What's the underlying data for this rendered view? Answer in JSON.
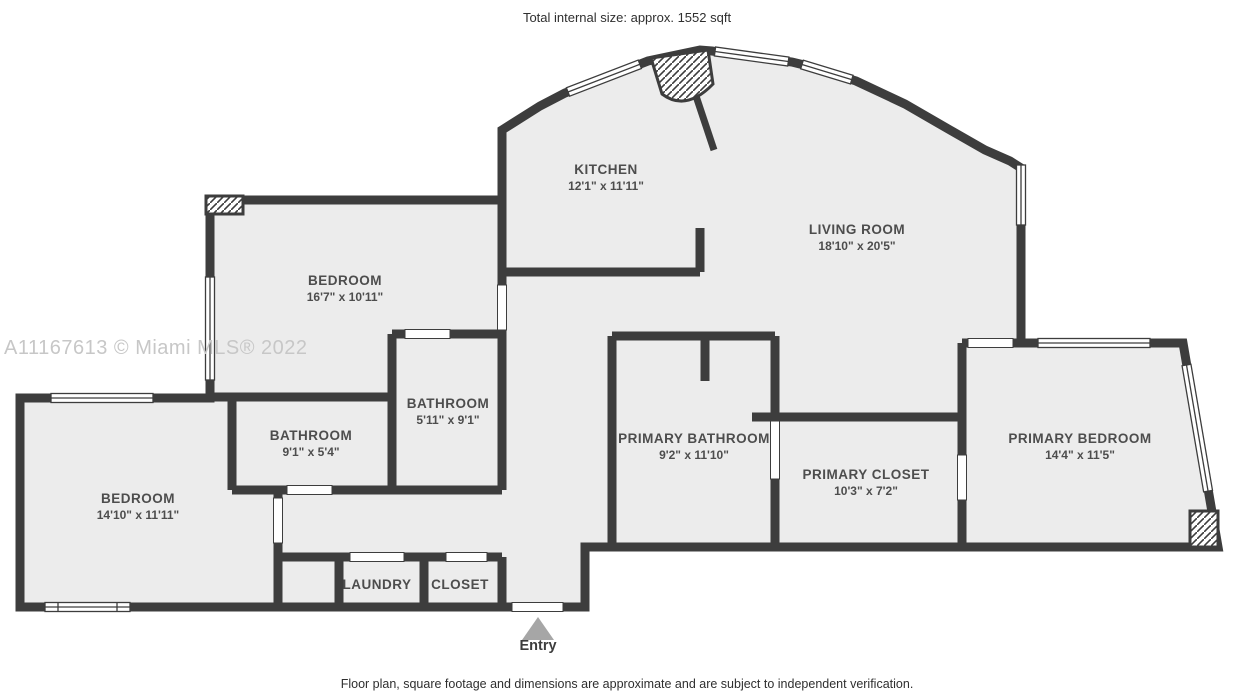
{
  "page": {
    "title": "Total internal size: approx. 1552 sqft",
    "disclaimer": "Floor plan, square footage and dimensions are approximate and are subject to independent verification.",
    "watermark": "A11167613 © Miami MLS® 2022"
  },
  "entry": {
    "label": "Entry"
  },
  "rooms": [
    {
      "id": "kitchen",
      "name": "KITCHEN",
      "dims": "12'1\" x 11'11\""
    },
    {
      "id": "living-room",
      "name": "LIVING ROOM",
      "dims": "18'10\" x 20'5\""
    },
    {
      "id": "bedroom-top",
      "name": "BEDROOM",
      "dims": "16'7\" x 10'11\""
    },
    {
      "id": "bathroom-ensuite",
      "name": "BATHROOM",
      "dims": "5'11\" x 9'1\""
    },
    {
      "id": "bathroom-hall",
      "name": "BATHROOM",
      "dims": "9'1\" x 5'4\""
    },
    {
      "id": "bedroom-left",
      "name": "BEDROOM",
      "dims": "14'10\" x 11'11\""
    },
    {
      "id": "primary-bathroom",
      "name": "PRIMARY BATHROOM",
      "dims": "9'2\" x 11'10\""
    },
    {
      "id": "primary-closet",
      "name": "PRIMARY CLOSET",
      "dims": "10'3\" x 7'2\""
    },
    {
      "id": "primary-bedroom",
      "name": "PRIMARY BEDROOM",
      "dims": "14'4\" x 11'5\""
    },
    {
      "id": "laundry",
      "name": "LAUNDRY"
    },
    {
      "id": "closet",
      "name": "CLOSET"
    }
  ],
  "colors": {
    "wall": "#3d3d3d",
    "floor": "#ececec",
    "label_text": "#4d4d4d",
    "watermark": "#c7c7c7",
    "entry_arrow": "#a6a6a6",
    "background": "#ffffff"
  }
}
